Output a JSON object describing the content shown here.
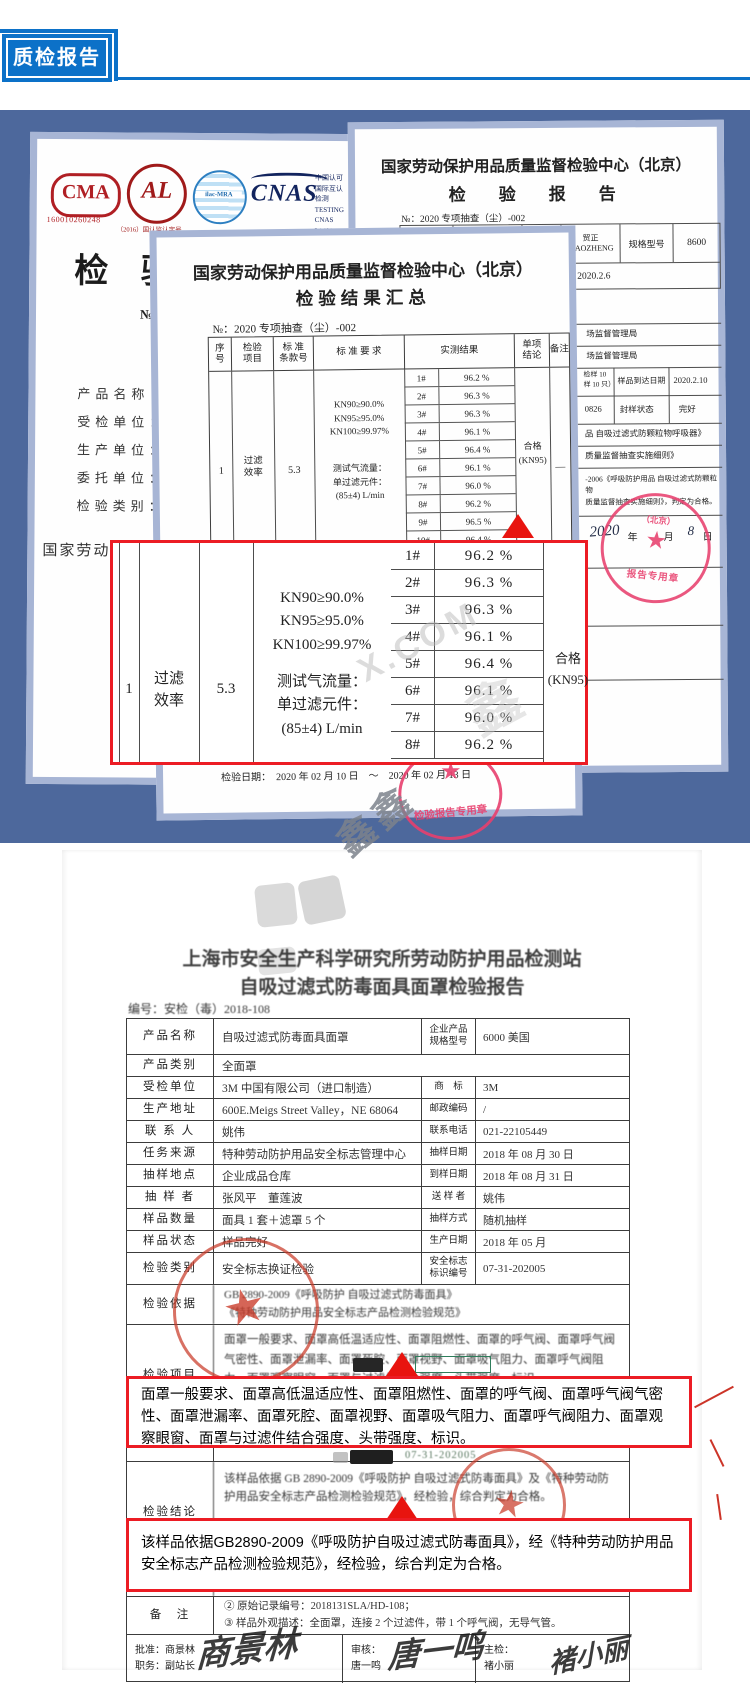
{
  "colors": {
    "accent_blue": "#0c71c8",
    "band_blue": "#4d689c",
    "paper_border": "#a7b5d5",
    "callout_red": "#ec1c24",
    "stamp_pink": "#e8406e",
    "stamp_red": "#c93a2e"
  },
  "header": {
    "title": "质检报告"
  },
  "left_doc": {
    "cma_text": "CMA",
    "cma_number": "160010260248",
    "cal_text": "AL",
    "cal_note": "（2016）国认监认字号",
    "ilac_text": "ilac-MRA",
    "cnas_text": "CNAS",
    "cert_lines": [
      "中国认可",
      "国际互认",
      "检测",
      "TESTING",
      "CNAS L1499"
    ],
    "title": "检 验 报 告",
    "no_label": "№：",
    "fields": [
      "产品名称：",
      "受检单位：",
      "生产单位：",
      "委托单位：",
      "检验类别："
    ],
    "footer": "国家劳动"
  },
  "right_doc": {
    "title": "国家劳动保护用品质量监督检验中心（北京）",
    "subtitle": "检　验　报　告",
    "no_line": "№：2020 专项抽查（尘）-002",
    "r1": {
      "c1": "产品名称",
      "c2": "折叠式防颗粒物\n随弃式面罩",
      "c3": "商标",
      "c4": "贸正\nMAOZHENG",
      "c5": "规格型号",
      "c6": "8600"
    },
    "r2": {
      "label": "生产日期/批号",
      "value": "2020.2.6"
    },
    "frag1": "场监督管理局",
    "frag2": "场监督管理局",
    "sample_row": {
      "c1": "检样 10\n样 10 只）",
      "c2": "样品到达日期",
      "c3": "2020.2.10"
    },
    "seal_row": {
      "c1": "0826",
      "c2": "封样状态",
      "c3": "完好"
    },
    "line1": "品  自吸过滤式防颗粒物呼吸器》",
    "line2": "质量监督抽查实施细则》",
    "line3": "-2006《呼吸防护用品 自吸过滤式防颗粒物\n质量监督抽查实施细则》，判定为合格。",
    "stamp_top": "（北京）",
    "stamp_bottom": "报告专用章",
    "date_script": "2020",
    "date_units": "年　　月",
    "date_day_script": "8",
    "date_day_unit": "日"
  },
  "summary_doc": {
    "title": "国家劳动保护用品质量监督检验中心（北京）",
    "subtitle": "检验结果汇总",
    "no_line": "№：2020 专项抽查（尘）-002",
    "h_seq": "序\n号",
    "h_item": "检验\n项目",
    "h_clause": "标 准\n条款号",
    "h_req": "标  准  要  求",
    "h_result": "实测结果",
    "h_verdict": "单项\n结论",
    "h_note": "备注",
    "req1": "KN90≥90.0%\nKN95≥95.0%\nKN100≥99.97%",
    "req2": "测试气流量：\n单过滤元件：\n(85±4) L/min",
    "seq": "1",
    "item": "过滤\n效率",
    "clause": "5.3",
    "verdict": "合格\n(KN95)",
    "note": "—",
    "results": [
      {
        "id": "1#",
        "val": "96.2 %"
      },
      {
        "id": "2#",
        "val": "96.3 %"
      },
      {
        "id": "3#",
        "val": "96.3 %"
      },
      {
        "id": "4#",
        "val": "96.1 %"
      },
      {
        "id": "5#",
        "val": "96.4 %"
      },
      {
        "id": "6#",
        "val": "96.1 %"
      },
      {
        "id": "7#",
        "val": "96.0 %"
      },
      {
        "id": "8#",
        "val": "96.2 %"
      },
      {
        "id": "9#",
        "val": "96.5 %"
      },
      {
        "id": "10#",
        "val": "96.4 %"
      }
    ],
    "date_line": "检验日期：　2020 年 02 月 10 日　～　2020 年 02 月 13 日",
    "stamp_text": "检验报告专用章"
  },
  "shanghai_doc": {
    "title": "上海市安全生产科学研究所劳动防护用品检测站",
    "subtitle": "自吸过滤式防毒面具面罩检验报告",
    "code_line": "编号：安检（毒）2018-108",
    "r_product": {
      "l": "产品名称",
      "v": "自吸过滤式防毒面具面罩",
      "rl": "企业产品\n规格型号",
      "rv": "6000 美国"
    },
    "r_category": {
      "l": "产品类别",
      "v": "全面罩"
    },
    "rows": [
      {
        "l": "受检单位",
        "v": "3M 中国有限公司（进口制造）",
        "rl": "商　标",
        "rv": "3M"
      },
      {
        "l": "生产地址",
        "v": "600E.Meigs Street Valley，NE 68064",
        "rl": "邮政编码",
        "rv": "/"
      },
      {
        "l": "联 系 人",
        "v": "姚伟",
        "rl": "联系电话",
        "rv": "021-22105449"
      },
      {
        "l": "任务来源",
        "v": "特种劳动防护用品安全标志管理中心",
        "rl": "抽样日期",
        "rv": "2018 年 08 月 30 日"
      },
      {
        "l": "抽样地点",
        "v": "企业成品仓库",
        "rl": "到样日期",
        "rv": "2018 年 08 月 31 日"
      },
      {
        "l": "抽 样 者",
        "v": "张风平　董莲波",
        "rl": "送 样 者",
        "rv": "姚伟"
      },
      {
        "l": "样品数量",
        "v": "面具 1 套＋滤罩 5 个",
        "rl": "抽样方式",
        "rv": "随机抽样"
      },
      {
        "l": "样品状态",
        "v": "样品完好",
        "rl": "生产日期",
        "rv": "2018 年 05 月"
      }
    ],
    "r_class": {
      "l": "检验类别",
      "v": "安全标志换证检验",
      "rl": "安全标志\n标识编号",
      "rv": "07-31-202005"
    },
    "r_basis": {
      "l": "检验依据",
      "v": "GB 2890-2009《呼吸防护  自吸过滤式防毒面具》\n《特种劳动防护用品安全标志产品检测检验规范》"
    },
    "r_items": {
      "l": "检验项目",
      "v": "面罩一般要求、面罩高低温适应性、面罩阻燃性、面罩的呼气阀、面罩呼气阀气密性、面罩泄漏率、面罩死腔、面罩视野、面罩吸气阻力、面罩呼气阀阻力、面罩观察眼窗、面罩与过滤件结合强度、头带强度、标识。"
    },
    "fragment_code": "07-31-202005",
    "r_conclusion": {
      "l": "检验结论",
      "v": "该样品依据 GB 2890-2009《呼吸防护  自吸过滤式防毒面具》及《特种劳动防护用品安全标志产品检测检验规范》，经检验，综合判定为合格。"
    },
    "r_note": {
      "l": "备　注",
      "v": "② 原始记录编号：2018131SLA/HD-108；\n③ 样品外观描述：全面罩，连接 2 个过滤件，带 1 个呼气阀，无导气管。"
    },
    "sign": {
      "approve": "批准：商景林",
      "duty": "职务：副站长",
      "review": "审核：",
      "review_name": "唐一鸣",
      "main": "主检：",
      "main_name": "褚小丽",
      "sig1": "商景林",
      "sig2": "唐一鸣",
      "sig3": "褚小丽"
    }
  },
  "callouts": {
    "c1": "面罩一般要求、面罩高低温适应性、面罩阻燃性、面罩的呼气阀、面罩呼气阀气密性、面罩泄漏率、面罩死腔、面罩视野、面罩吸气阻力、面罩呼气阀阻力、面罩观察眼窗、面罩与过滤件结合强度、头带强度、标识。",
    "c2": "该样品依据GB2890-2009《呼吸防护自吸过滤式防毒面具》，经《特种劳动防护用品安全标志产品检测检验规范》，经检验，综合判定为合格。"
  },
  "watermarks": {
    "com": "X.COM",
    "glyph": "鑫",
    "dark": "鑫鑫"
  }
}
